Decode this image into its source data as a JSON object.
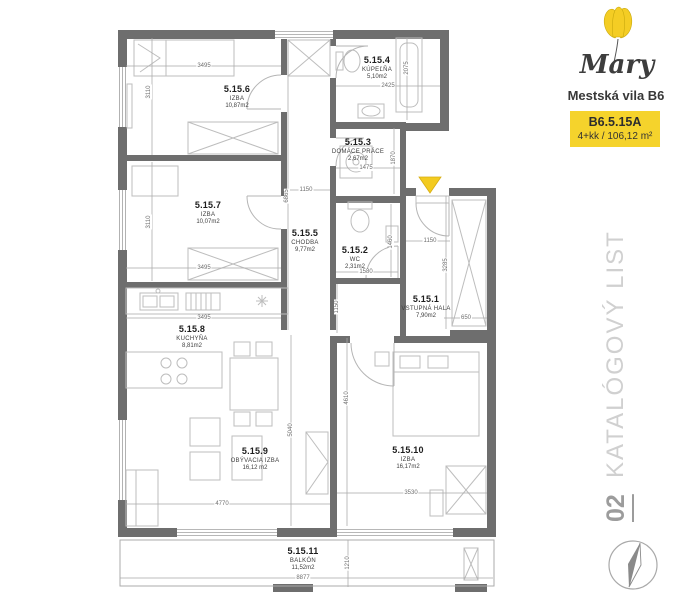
{
  "panel": {
    "brand_script": "Mary",
    "brand_subtitle": "Mestská vila B6",
    "unit_code": "B6.5.15A",
    "unit_spec": "4+kk / 106,12 m²",
    "side_title": "KATALÓGOVÝ LIST",
    "page_number": "02",
    "icons": {
      "logo": "tulip-logo-icon",
      "compass": "compass-icon",
      "entrance": "entrance-arrow-icon"
    },
    "colors": {
      "accent_yellow": "#F5D32C",
      "wall_gray": "#6E6E6E"
    }
  },
  "plan": {
    "rooms": [
      {
        "id": "5.15.1",
        "name": "VSTUPNÁ HALA",
        "area": "7,90m2"
      },
      {
        "id": "5.15.2",
        "name": "WC",
        "area": "2,31m2"
      },
      {
        "id": "5.15.3",
        "name": "DOMÁCE PRÁCE",
        "area": "2,67m2"
      },
      {
        "id": "5.15.4",
        "name": "KÚPEĽŇA",
        "area": "5,10m2"
      },
      {
        "id": "5.15.5",
        "name": "CHODBA",
        "area": "9,77m2"
      },
      {
        "id": "5.15.6",
        "name": "IZBA",
        "area": "10,87m2"
      },
      {
        "id": "5.15.7",
        "name": "IZBA",
        "area": "10,07m2"
      },
      {
        "id": "5.15.8",
        "name": "KUCHYŇA",
        "area": "8,81m2"
      },
      {
        "id": "5.15.9",
        "name": "OBÝVACIA IZBA",
        "area": "16,12 m2"
      },
      {
        "id": "5.15.10",
        "name": "IZBA",
        "area": "16,17m2"
      },
      {
        "id": "5.15.11",
        "name": "BALKÓN",
        "area": "11,52m2"
      }
    ],
    "dims": [
      "3495",
      "3110",
      "3495",
      "3110",
      "3495",
      "2425",
      "2075",
      "1475",
      "1870",
      "1150",
      "6865",
      "1580",
      "1460",
      "1150",
      "1150",
      "3285",
      "650",
      "5040",
      "4770",
      "4610",
      "3530",
      "8877",
      "1210"
    ]
  }
}
